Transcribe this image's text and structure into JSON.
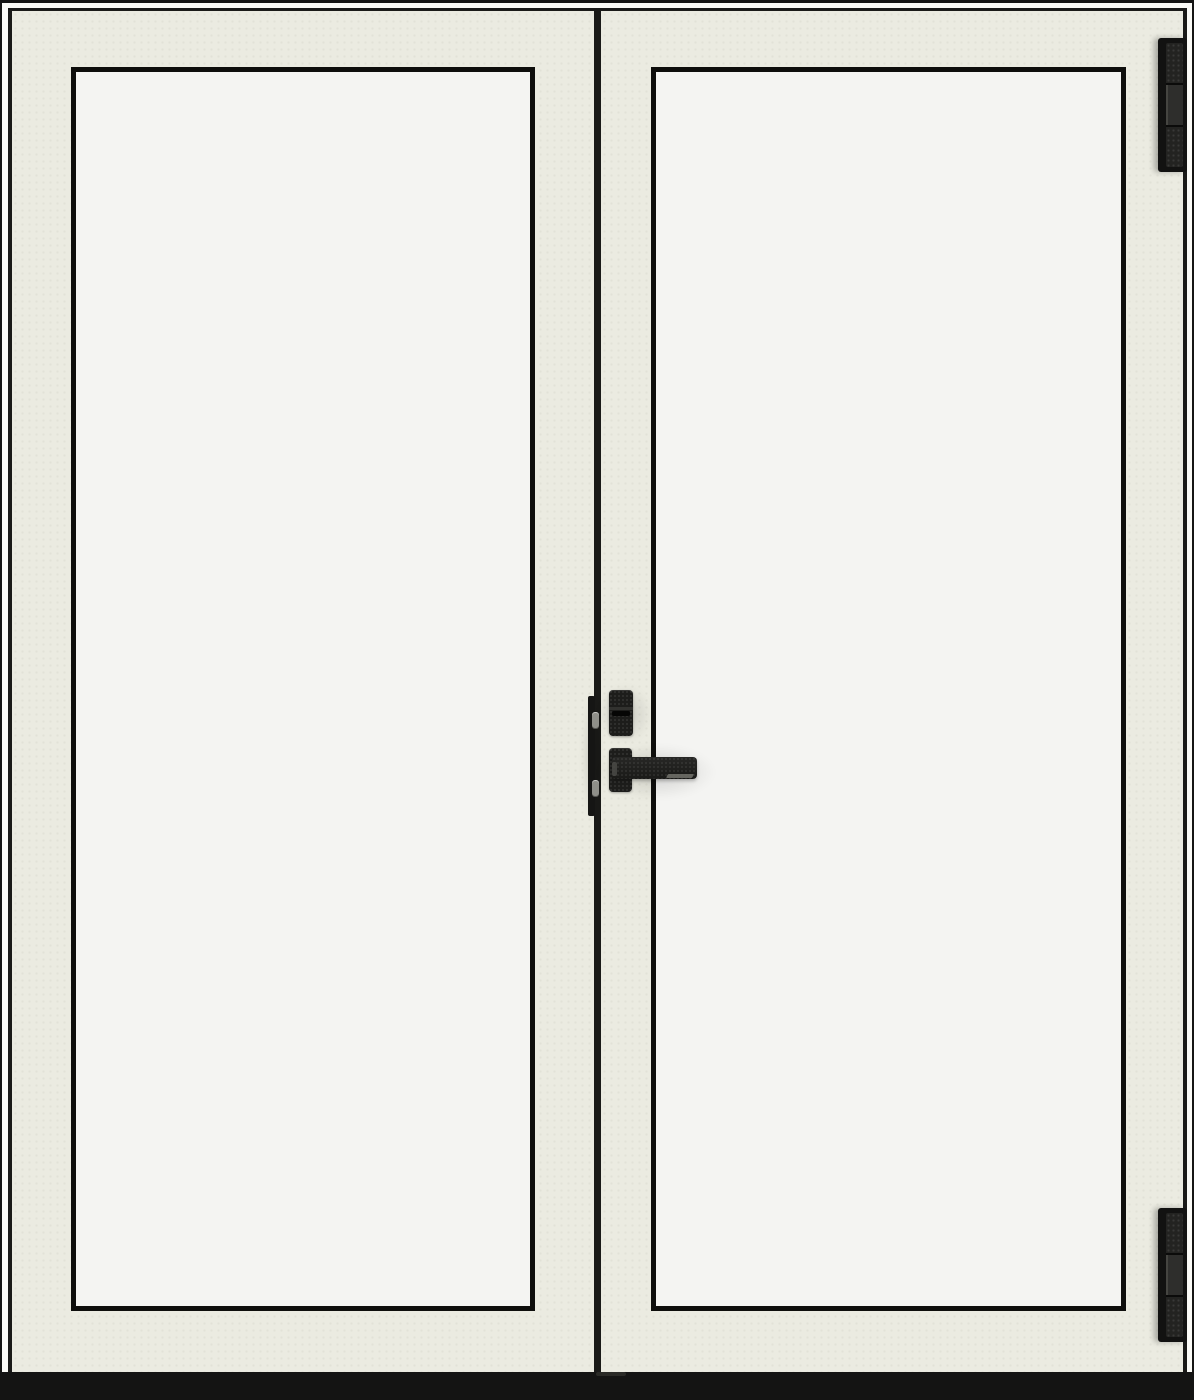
{
  "product": {
    "name": "white-double-french-door-black-hardware",
    "description": "Closed double glass door unit, white-cream frame, full-lite clear panels, matte black lever handle, thumbturn lock, two right-side hinges and black threshold sill"
  },
  "colors": {
    "page_bg": "#ffffff",
    "outline_black": "#151514",
    "frame_white": "#fbfbf7",
    "frame_shadow": "#1a1a18",
    "door_cream": "#ebebe1",
    "glass": "#f4f4f2",
    "glazing_bead": "#0e0e0c",
    "hardware_black": "#1d1d1b",
    "hardware_highlight": "#6e6e67",
    "screw_gray": "#8f8f89",
    "sill_black": "#141413"
  },
  "components": {
    "left_panel": "left-door-panel",
    "right_panel": "right-door-panel",
    "meeting_stile": "center-meeting-gap",
    "lock": "thumbturn-lock-body",
    "handle": "lever-door-handle",
    "astragal": "lock-edge-faceplate",
    "screws": [
      "strike-screw-top",
      "strike-screw-bottom"
    ],
    "hinges": [
      "top-hinge",
      "bottom-hinge"
    ],
    "sill": "threshold-sill"
  }
}
